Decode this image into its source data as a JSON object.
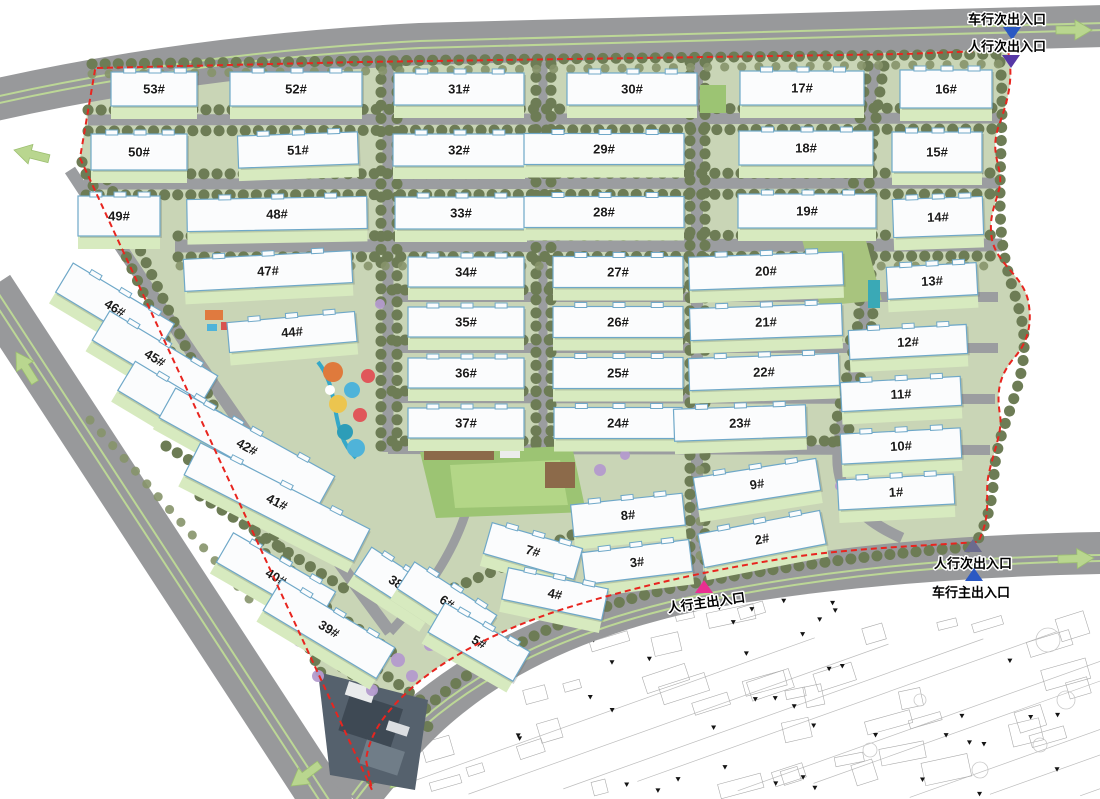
{
  "plan": {
    "type": "residential-master-plan",
    "units": "building numbers with # suffix"
  },
  "colors": {
    "boundary_red": "#e8251f",
    "building_fill": "#fbfcfd",
    "building_outline": "#6fa8c8",
    "road_gray": "#98999b",
    "road_line_green": "#bcd796",
    "site_green": "#c9d5b6",
    "tree_olive": "#6d7c55",
    "tree_purple": "#b49bce",
    "lawn": "#d7eabf",
    "arrow_green": "#b9d68f",
    "entrance_blue": "#2b59c3",
    "entrance_purple": "#5638a6",
    "entrance_slate": "#6b6b8e",
    "entrance_pink": "#ea2f90"
  },
  "entrances": [
    {
      "id": "vehicle-secondary-top",
      "label": "车行次出入口",
      "color": "#2b59c3",
      "dir": "down",
      "tx": 1012,
      "ty": 33,
      "lx": 1007,
      "ly": 24,
      "rot": 0
    },
    {
      "id": "pedestrian-secondary-top",
      "label": "人行次出入口",
      "color": "#5638a6",
      "dir": "down",
      "tx": 1011,
      "ty": 61,
      "lx": 1007,
      "ly": 51,
      "rot": 0
    },
    {
      "id": "pedestrian-secondary-right",
      "label": "人行次出入口",
      "color": "#6b6b8e",
      "dir": "up",
      "tx": 973,
      "ty": 546,
      "lx": 973,
      "ly": 568,
      "rot": 0
    },
    {
      "id": "vehicle-main-right",
      "label": "车行主出入口",
      "color": "#2b59c3",
      "dir": "up",
      "tx": 974,
      "ty": 575,
      "lx": 971,
      "ly": 597,
      "rot": 0
    },
    {
      "id": "pedestrian-main-bottom",
      "label": "人行主出入口",
      "color": "#ea2f90",
      "dir": "up",
      "tx": 704,
      "ty": 587,
      "lx": 707,
      "ly": 607,
      "rot": -8
    }
  ],
  "buildings": [
    {
      "label": "53#",
      "x": 154,
      "y": 89,
      "w": 86,
      "h": 34,
      "rot": 0
    },
    {
      "label": "52#",
      "x": 296,
      "y": 89,
      "w": 132,
      "h": 34,
      "rot": 0
    },
    {
      "label": "31#",
      "x": 459,
      "y": 89,
      "w": 130,
      "h": 32,
      "rot": 0
    },
    {
      "label": "30#",
      "x": 632,
      "y": 89,
      "w": 130,
      "h": 32,
      "rot": 0
    },
    {
      "label": "17#",
      "x": 802,
      "y": 88,
      "w": 124,
      "h": 34,
      "rot": 0
    },
    {
      "label": "16#",
      "x": 946,
      "y": 89,
      "w": 92,
      "h": 38,
      "rot": 0
    },
    {
      "label": "50#",
      "x": 139,
      "y": 152,
      "w": 96,
      "h": 36,
      "rot": 0
    },
    {
      "label": "51#",
      "x": 298,
      "y": 150,
      "w": 120,
      "h": 32,
      "rot": -2
    },
    {
      "label": "32#",
      "x": 459,
      "y": 150,
      "w": 132,
      "h": 32,
      "rot": 0
    },
    {
      "label": "29#",
      "x": 604,
      "y": 149,
      "w": 160,
      "h": 31,
      "rot": 0
    },
    {
      "label": "18#",
      "x": 806,
      "y": 148,
      "w": 134,
      "h": 34,
      "rot": 0
    },
    {
      "label": "15#",
      "x": 937,
      "y": 152,
      "w": 90,
      "h": 40,
      "rot": 0
    },
    {
      "label": "49#",
      "x": 119,
      "y": 216,
      "w": 82,
      "h": 40,
      "rot": 0
    },
    {
      "label": "48#",
      "x": 277,
      "y": 214,
      "w": 180,
      "h": 32,
      "rot": -1
    },
    {
      "label": "33#",
      "x": 461,
      "y": 213,
      "w": 132,
      "h": 32,
      "rot": 0
    },
    {
      "label": "28#",
      "x": 604,
      "y": 212,
      "w": 160,
      "h": 31,
      "rot": 0
    },
    {
      "label": "19#",
      "x": 807,
      "y": 211,
      "w": 138,
      "h": 34,
      "rot": 0
    },
    {
      "label": "14#",
      "x": 938,
      "y": 217,
      "w": 90,
      "h": 38,
      "rot": -2
    },
    {
      "label": "47#",
      "x": 268,
      "y": 271,
      "w": 168,
      "h": 32,
      "rot": -3
    },
    {
      "label": "34#",
      "x": 466,
      "y": 272,
      "w": 116,
      "h": 30,
      "rot": 0
    },
    {
      "label": "27#",
      "x": 618,
      "y": 272,
      "w": 130,
      "h": 31,
      "rot": 0
    },
    {
      "label": "20#",
      "x": 766,
      "y": 271,
      "w": 154,
      "h": 33,
      "rot": -2
    },
    {
      "label": "13#",
      "x": 932,
      "y": 281,
      "w": 90,
      "h": 32,
      "rot": -3
    },
    {
      "label": "46#",
      "x": 115,
      "y": 308,
      "w": 118,
      "h": 34,
      "rot": 31
    },
    {
      "label": "44#",
      "x": 292,
      "y": 332,
      "w": 128,
      "h": 30,
      "rot": -5
    },
    {
      "label": "35#",
      "x": 466,
      "y": 322,
      "w": 116,
      "h": 30,
      "rot": 0
    },
    {
      "label": "26#",
      "x": 618,
      "y": 322,
      "w": 130,
      "h": 31,
      "rot": 0
    },
    {
      "label": "21#",
      "x": 766,
      "y": 322,
      "w": 152,
      "h": 32,
      "rot": -2
    },
    {
      "label": "12#",
      "x": 908,
      "y": 342,
      "w": 118,
      "h": 29,
      "rot": -3
    },
    {
      "label": "45#",
      "x": 155,
      "y": 358,
      "w": 126,
      "h": 34,
      "rot": 31
    },
    {
      "label": "36#",
      "x": 466,
      "y": 373,
      "w": 116,
      "h": 30,
      "rot": 0
    },
    {
      "label": "25#",
      "x": 618,
      "y": 373,
      "w": 130,
      "h": 31,
      "rot": 0
    },
    {
      "label": "22#",
      "x": 764,
      "y": 372,
      "w": 150,
      "h": 32,
      "rot": -2
    },
    {
      "label": "11#",
      "x": 901,
      "y": 394,
      "w": 120,
      "h": 29,
      "rot": -3
    },
    {
      "label": "43#",
      "x": 190,
      "y": 414,
      "w": 148,
      "h": 34,
      "rot": 31
    },
    {
      "label": "37#",
      "x": 466,
      "y": 423,
      "w": 116,
      "h": 30,
      "rot": 0
    },
    {
      "label": "24#",
      "x": 618,
      "y": 423,
      "w": 128,
      "h": 31,
      "rot": 0
    },
    {
      "label": "23#",
      "x": 740,
      "y": 423,
      "w": 132,
      "h": 32,
      "rot": -2
    },
    {
      "label": "10#",
      "x": 901,
      "y": 446,
      "w": 120,
      "h": 30,
      "rot": -3
    },
    {
      "label": "42#",
      "x": 247,
      "y": 447,
      "w": 182,
      "h": 34,
      "rot": 29
    },
    {
      "label": "9#",
      "x": 757,
      "y": 484,
      "w": 124,
      "h": 32,
      "rot": -9
    },
    {
      "label": "1#",
      "x": 896,
      "y": 492,
      "w": 116,
      "h": 30,
      "rot": -3
    },
    {
      "label": "41#",
      "x": 277,
      "y": 502,
      "w": 190,
      "h": 36,
      "rot": 27
    },
    {
      "label": "8#",
      "x": 628,
      "y": 515,
      "w": 112,
      "h": 32,
      "rot": -6
    },
    {
      "label": "2#",
      "x": 762,
      "y": 539,
      "w": 124,
      "h": 34,
      "rot": -11
    },
    {
      "label": "40#",
      "x": 276,
      "y": 577,
      "w": 118,
      "h": 34,
      "rot": 30
    },
    {
      "label": "38#",
      "x": 399,
      "y": 584,
      "w": 86,
      "h": 32,
      "rot": 33
    },
    {
      "label": "7#",
      "x": 533,
      "y": 551,
      "w": 94,
      "h": 32,
      "rot": 16
    },
    {
      "label": "3#",
      "x": 637,
      "y": 562,
      "w": 108,
      "h": 32,
      "rot": -7
    },
    {
      "label": "6#",
      "x": 447,
      "y": 602,
      "w": 98,
      "h": 32,
      "rot": 33
    },
    {
      "label": "4#",
      "x": 555,
      "y": 594,
      "w": 102,
      "h": 32,
      "rot": 12
    },
    {
      "label": "39#",
      "x": 329,
      "y": 629,
      "w": 132,
      "h": 36,
      "rot": 31
    },
    {
      "label": "5#",
      "x": 479,
      "y": 642,
      "w": 98,
      "h": 34,
      "rot": 30
    }
  ]
}
